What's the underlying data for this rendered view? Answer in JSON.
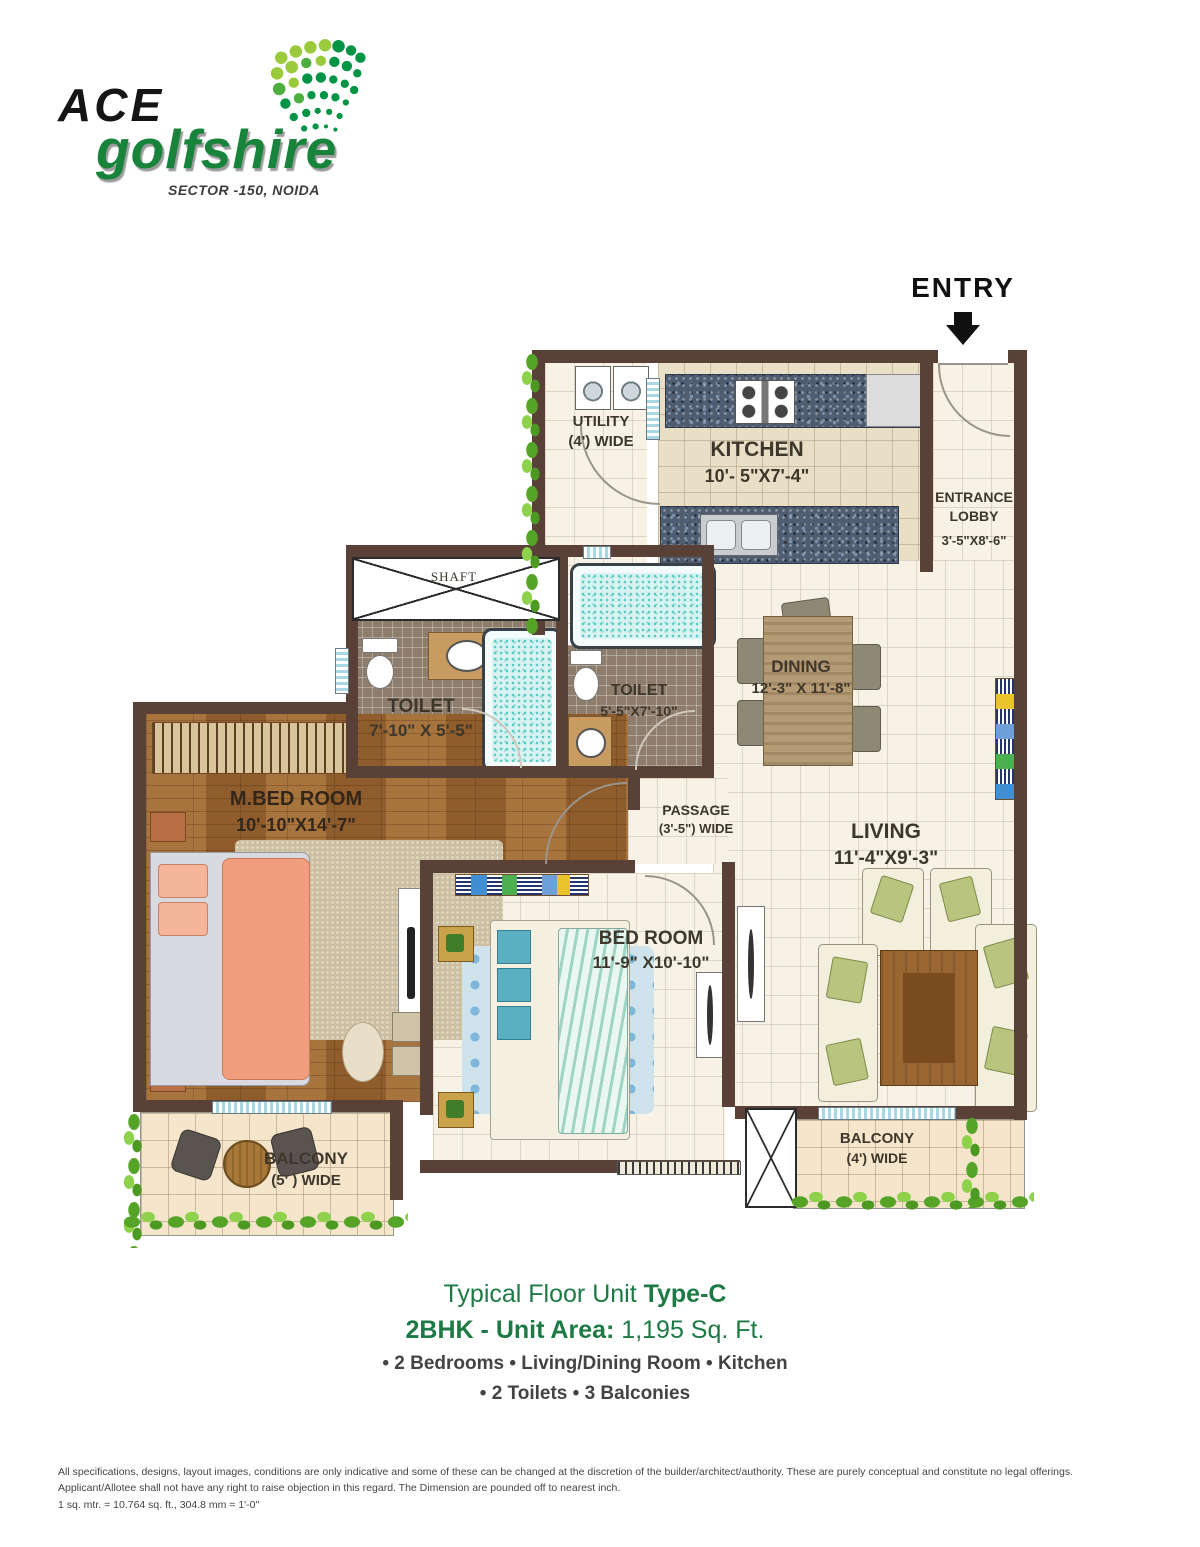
{
  "logo": {
    "brand": "ACE",
    "name": "golfshire",
    "tagline": "SECTOR -150, NOIDA"
  },
  "entry": {
    "label": "ENTRY"
  },
  "plan": {
    "utility": {
      "name": "UTILITY",
      "dims": "(4')  WIDE"
    },
    "kitchen": {
      "name": "KITCHEN",
      "dims": "10'- 5\"X7'-4\""
    },
    "entrance_lobby": {
      "line1": "ENTRANCE",
      "line2": "LOBBY",
      "dims": "3'-5\"X8'-6\""
    },
    "shaft": {
      "name": "SHAFT"
    },
    "toilet_master": {
      "name": "TOILET",
      "dims": "7'-10\" X 5'-5\""
    },
    "toilet_common": {
      "name": "TOILET",
      "dims": "5'-5\"X7'-10\""
    },
    "dining": {
      "name": "DINING",
      "dims": "12'-3\" X 11'-8\""
    },
    "passage": {
      "name": "PASSAGE",
      "dims": "(3'-5\")  WIDE"
    },
    "living": {
      "name": "LIVING",
      "dims": "11'-4\"X9'-3\""
    },
    "master_bedroom": {
      "name": "M.BED ROOM",
      "dims": "10'-10\"X14'-7\""
    },
    "bedroom": {
      "name": "BED ROOM",
      "dims": "11'-9\" X10'-10\""
    },
    "balcony_left": {
      "name": "BALCONY",
      "dims": "(5' ) WIDE"
    },
    "balcony_right": {
      "name": "BALCONY",
      "dims": "(4')  WIDE"
    }
  },
  "footer": {
    "title_prefix": "Typical Floor Unit ",
    "title_bold": "Type-C",
    "area_bold": "2BHK - Unit Area:",
    "area_value": " 1,195 Sq. Ft.",
    "features_line1": "• 2 Bedrooms • Living/Dining Room • Kitchen",
    "features_line2": "• 2 Toilets • 3 Balconies"
  },
  "disclaimer": {
    "line1": "All specifications, designs, layout images, conditions are only indicative and some of these can be changed at the discretion of the builder/architect/authority. These are purely conceptual and constitute no legal offerings.",
    "line2": "Applicant/Allotee shall not have any right to raise objection in this regard. The Dimension are pounded off to nearest inch.",
    "line3": "1 sq. mtr. = 10.764 sq. ft., 304.8 mm = 1'-0''"
  },
  "colors": {
    "brand_green": "#17833b",
    "logo_black": "#151515",
    "wall_brown": "#5a4138",
    "footer_green": "#1d7a44",
    "footer_gray": "#434343"
  }
}
